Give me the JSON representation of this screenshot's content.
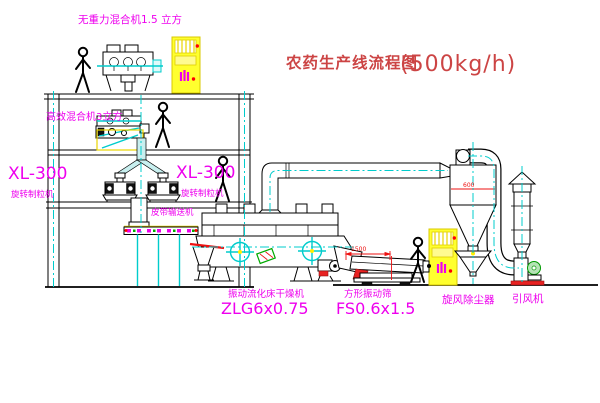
{
  "title": {
    "text": "农药生产线流程图",
    "capacity": "(500kg/h)"
  },
  "equipment_labels": {
    "gravity_free_mixer": "无重力混合机1.5 立方",
    "high_efficiency_mixer": "高效混合机3立方",
    "granulator_left_model": "XL-300",
    "granulator_left_name": "旋转制粒机",
    "granulator_right_model": "XL-300",
    "granulator_right_name": "旋转制粒机",
    "belt_conveyor": "皮带输送机",
    "fluid_bed_dryer_name": "振动流化床干燥机",
    "fluid_bed_dryer_model": "ZLG6x0.75",
    "square_vibrating_sieve_name": "方形振动筛",
    "square_vibrating_sieve_model": "FS0.6x1.5",
    "cyclone_dust_collector": "旋风除尘器",
    "induced_draft_fan": "引风机"
  },
  "dimensions": {
    "sieve_length": "1500",
    "duct_size": "600"
  },
  "colors": {
    "line": "#000000",
    "centerline": "#00cccc",
    "label": "#ee00ee",
    "title": "#cc4444",
    "dimension": "#ee1111",
    "cabinet": "#ffff2e",
    "machine_green": "#00aa00"
  }
}
